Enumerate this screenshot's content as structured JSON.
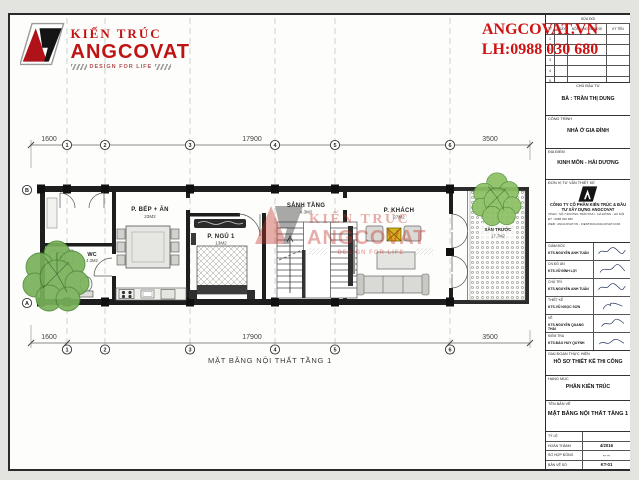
{
  "brand": {
    "title": "KIẾN TRÚC",
    "name": "ANGCOVAT",
    "tagline": "DESIGN FOR LIFE"
  },
  "contact": {
    "website": "ANGCOVAT.VN",
    "phone": "LH:0988 030 680"
  },
  "revision_table": {
    "title": "SỬA ĐỔI",
    "columns": [
      "TT",
      "NGÀY",
      "NỘI DUNG SỬA ĐỔI",
      "KÝ TÊN"
    ],
    "rows": [
      "1",
      "2",
      "3",
      "4",
      "5"
    ]
  },
  "titleblock": {
    "client_label": "CHỦ ĐẦU TƯ",
    "client": "BÀ : TRẦN THỊ DUNG",
    "project_label": "CÔNG TRÌNH",
    "project": "NHÀ Ở GIA ĐÌNH",
    "location_label": "ĐỊA ĐIỂM",
    "location": "KINH MÔN - HẢI DƯƠNG",
    "consultant_label": "ĐƠN VỊ TƯ VẤN THIẾT KẾ",
    "company": "CÔNG TY CỔ PHẦN KIẾN TRÚC & ĐẦU TƯ XÂY DỰNG ANGCOVAT",
    "company_lines": [
      "VPGD : SỐ 7 ĐƯỜNG TRẦN PHÚ - HÀ ĐÔNG - HÀ NỘI",
      "ĐT : 0988 030 680",
      "WEB : ANGCOVAT.VN - KIENTRUCANGCOVAT.COM"
    ],
    "signatures": [
      {
        "role": "GIÁM ĐỐC",
        "name": "KTS.NGUYỄN ANH TUẤN"
      },
      {
        "role": "CN ĐỒ ÁN",
        "name": "KTS.VŨ ĐÌNH LỢI"
      },
      {
        "role": "CHỦ TRÌ",
        "name": "KTS.NGUYỄN ANH TUẤN"
      },
      {
        "role": "THIẾT KẾ",
        "name": "KTS.VŨ NGỌC SƠN"
      },
      {
        "role": "VẼ",
        "name": "KTS.NGUYỄN QUANG THÁI"
      },
      {
        "role": "KIỂM TRA",
        "name": "KTS.ĐÀO HUY QUỲNH"
      }
    ],
    "phase_label": "GIAI ĐOẠN THỰC HIỆN",
    "phase": "HỒ SƠ THIẾT KẾ THI CÔNG",
    "category_label": "HẠNG MỤC",
    "category": "PHẦN KIẾN TRÚC",
    "drawing_label": "TÊN BẢN VẼ",
    "drawing": "MẶT BẰNG NỘI THẤT TẦNG 1",
    "meta": [
      {
        "label": "TỶ LỆ",
        "value": ""
      },
      {
        "label": "HOÀN THÀNH",
        "value": "4/2016"
      },
      {
        "label": "SỐ HỢP ĐỒNG",
        "value": "-- --"
      },
      {
        "label": "BẢN VẼ SỐ",
        "value": "KT-01"
      }
    ]
  },
  "plan": {
    "caption": "MẶT BẰNG NỘI THẤT TẦNG 1",
    "dims_top": [
      "1600",
      "17900",
      "3500"
    ],
    "dims_bottom": [
      "1600",
      "17900",
      "3500"
    ],
    "axes": [
      "1",
      "2",
      "3",
      "4",
      "5",
      "6"
    ],
    "axes_left": [
      "B",
      "A"
    ],
    "rooms": [
      {
        "name": "P. BẾP + ĂN",
        "area": "23M2"
      },
      {
        "name": "P. NGỦ 1",
        "area": "13M2"
      },
      {
        "name": "SẢNH TẦNG",
        "area": "4.3M2"
      },
      {
        "name": "P. KHÁCH",
        "area": "27M2"
      },
      {
        "name": "WC",
        "area": "4.3M2"
      },
      {
        "name": "SÂN TRƯỚC",
        "area": "17.7M2"
      }
    ],
    "watermark": {
      "line1": "KIẾN TRÚC",
      "line2": "ANGCOVAT",
      "line3": "DESIGN FOR LIFE"
    }
  }
}
